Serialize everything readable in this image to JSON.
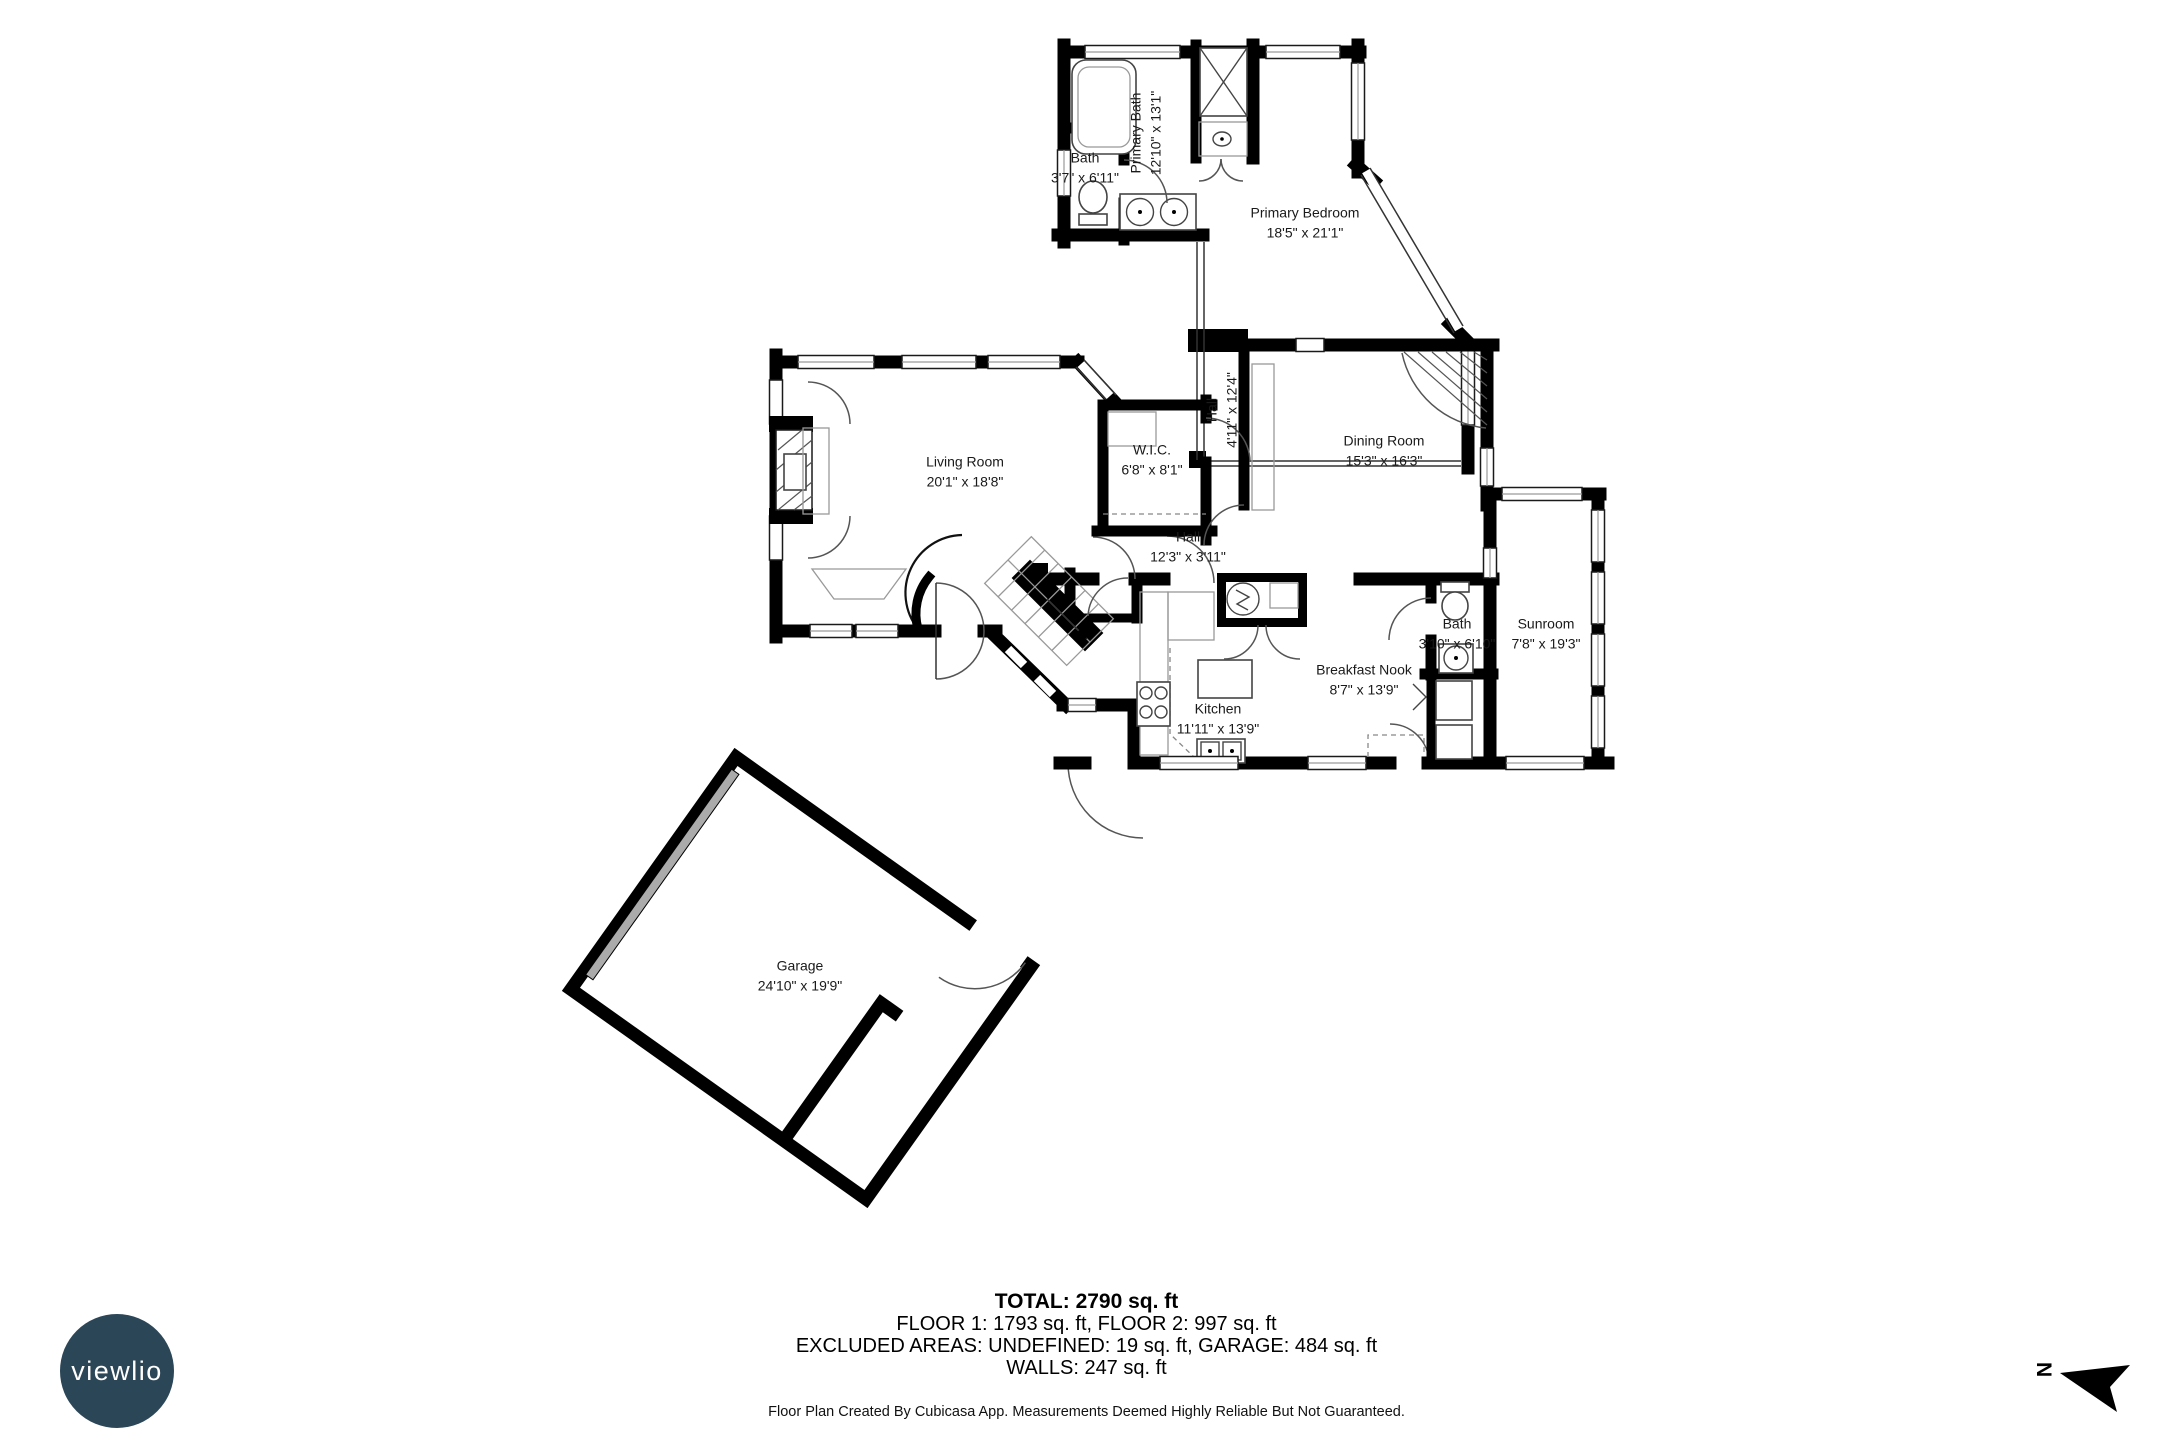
{
  "rooms": [
    {
      "id": "living-room",
      "name": "Living Room",
      "dims": "20'1\" x 18'8\""
    },
    {
      "id": "wic",
      "name": "W.I.C.",
      "dims": "6'8\" x 8'1\""
    },
    {
      "id": "hall-upper",
      "name": "Hall",
      "dims": "4'11\" x 12'4\""
    },
    {
      "id": "dining-room",
      "name": "Dining Room",
      "dims": "15'3\" x 16'3\""
    },
    {
      "id": "hall-lower",
      "name": "Hall",
      "dims": "12'3\" x 3'11\""
    },
    {
      "id": "kitchen",
      "name": "Kitchen",
      "dims": "11'11\" x 13'9\""
    },
    {
      "id": "breakfast-nook",
      "name": "Breakfast Nook",
      "dims": "8'7\" x 13'9\""
    },
    {
      "id": "bath-first-floor",
      "name": "Bath",
      "dims": "3'10\" x 6'10\""
    },
    {
      "id": "sunroom",
      "name": "Sunroom",
      "dims": "7'8\" x 19'3\""
    },
    {
      "id": "primary-bath",
      "name": "Primary Bath",
      "dims": "12'10\" x 13'1\""
    },
    {
      "id": "bath-second-floor",
      "name": "Bath",
      "dims": "3'7\" x 6'11\""
    },
    {
      "id": "primary-bedroom",
      "name": "Primary Bedroom",
      "dims": "18'5\" x 21'1\""
    },
    {
      "id": "garage",
      "name": "Garage",
      "dims": "24'10\" x 19'9\""
    }
  ],
  "summary": {
    "total": "TOTAL: 2790 sq. ft",
    "floors": "FLOOR 1: 1793 sq. ft, FLOOR 2: 997 sq. ft",
    "excluded": "EXCLUDED AREAS: UNDEFINED: 19 sq. ft, GARAGE: 484 sq. ft",
    "walls": "WALLS: 247 sq. ft"
  },
  "meta": {
    "credit": "Floor Plan Created By Cubicasa App. Measurements Deemed Highly Reliable But Not Guaranteed."
  },
  "logo": {
    "text": "viewlio"
  },
  "compass": {
    "label": "N"
  },
  "colors": {
    "wall": "#000000",
    "background": "#ffffff",
    "logo_circle": "#2b4657",
    "logo_text": "#ffffff"
  }
}
